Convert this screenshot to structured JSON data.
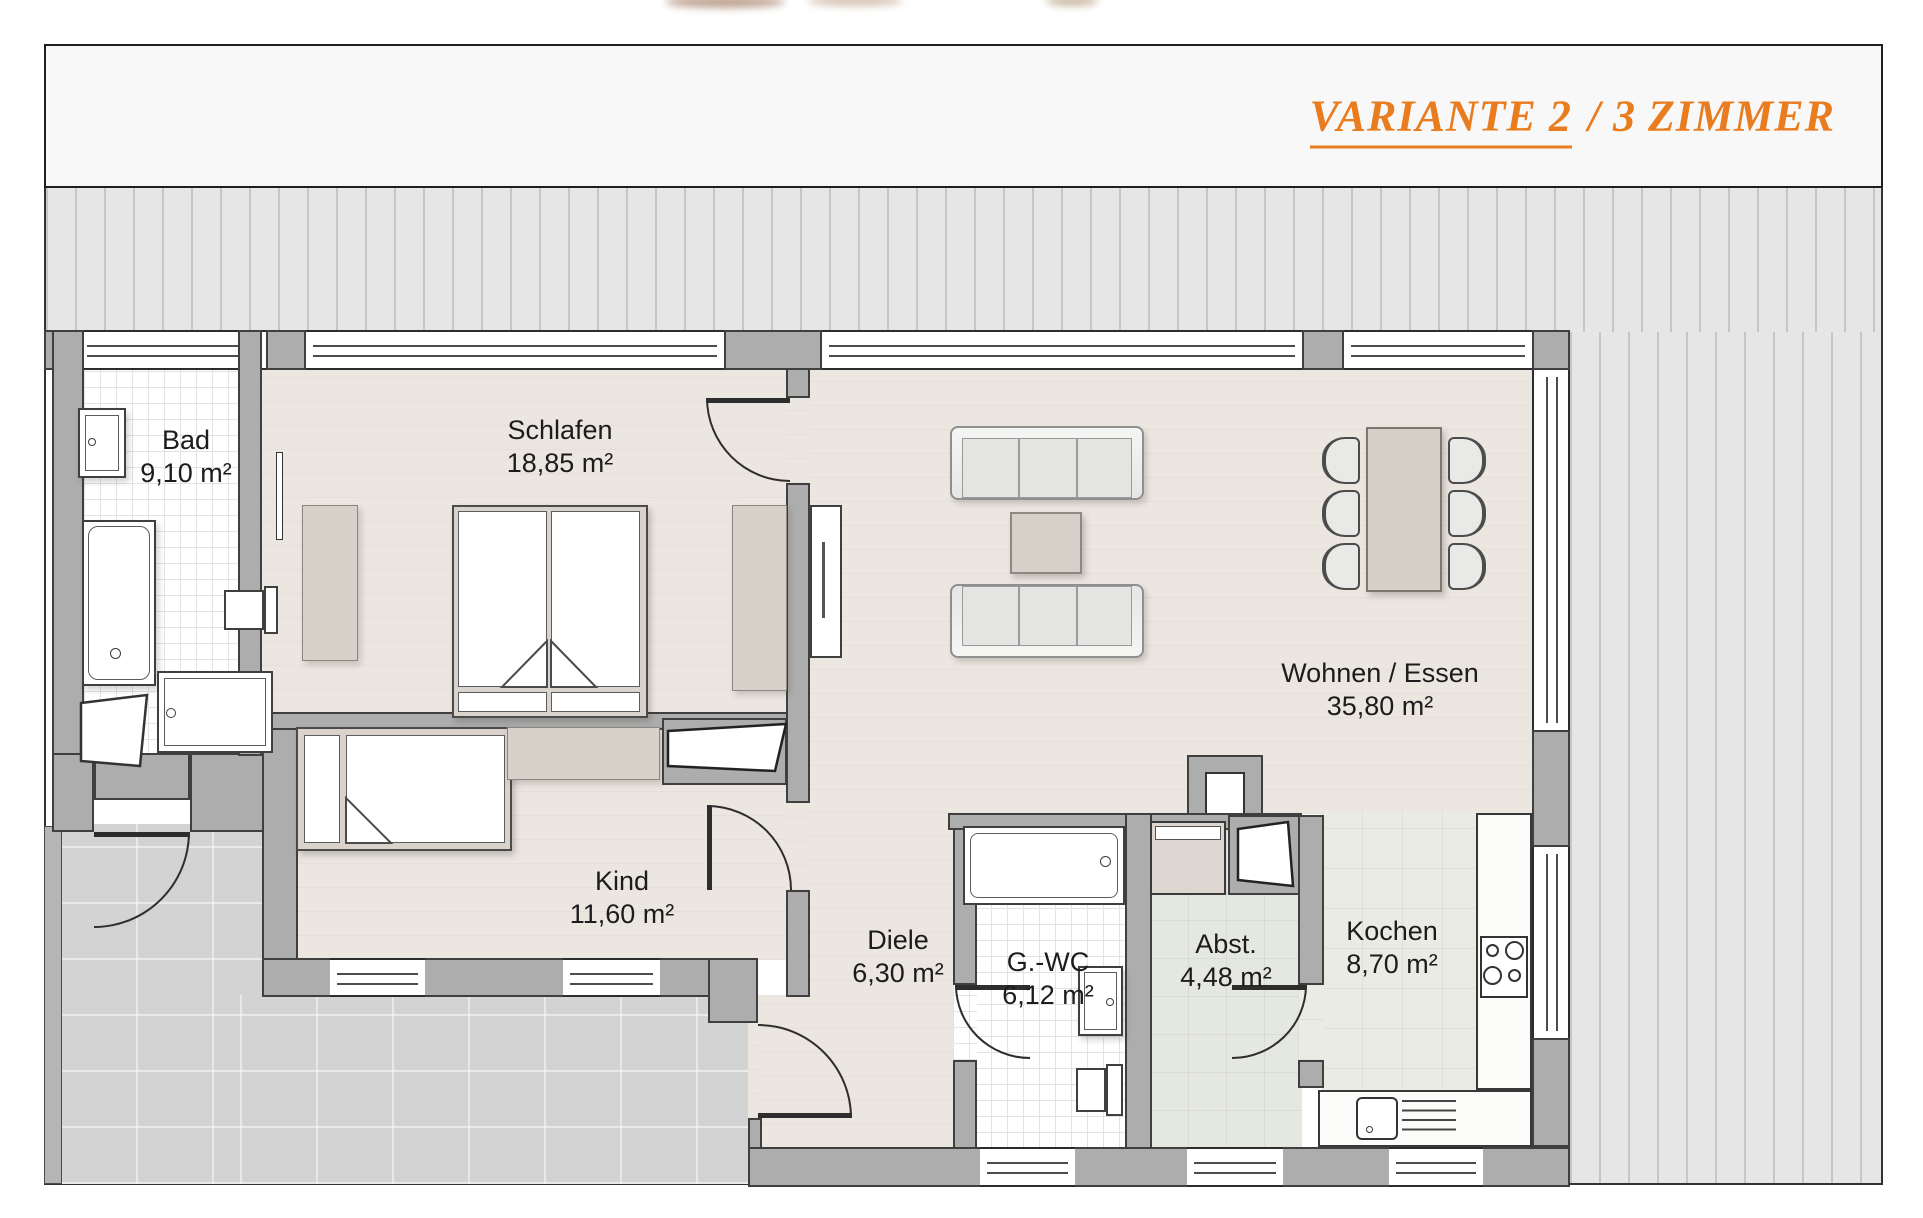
{
  "title": {
    "variant": "VARIANTE 2",
    "rest": "/ 3 ZIMMER"
  },
  "rooms": {
    "bad": {
      "name": "Bad",
      "area": "9,10 m²"
    },
    "schlafen": {
      "name": "Schlafen",
      "area": "18,85 m²"
    },
    "kind": {
      "name": "Kind",
      "area": "11,60 m²"
    },
    "diele": {
      "name": "Diele",
      "area": "6,30 m²"
    },
    "gwc": {
      "name": "G.-WC",
      "area": "6,12 m²"
    },
    "abst": {
      "name": "Abst.",
      "area": "4,48 m²"
    },
    "kochen": {
      "name": "Kochen",
      "area": "8,70 m²"
    },
    "wohnen": {
      "name": "Wohnen / Essen",
      "area": "35,80 m²"
    }
  },
  "colors": {
    "accent_orange": "#e87c1e",
    "wall_gray": "#adadad",
    "outline": "#2d2d2d",
    "floor_wood": "#ece6e1",
    "floor_tile_white": "#ffffff",
    "floor_kitchen": "#eaece4",
    "terrace_gray": "#d2d3d2",
    "deck_stripe": "#e6e6e6"
  }
}
